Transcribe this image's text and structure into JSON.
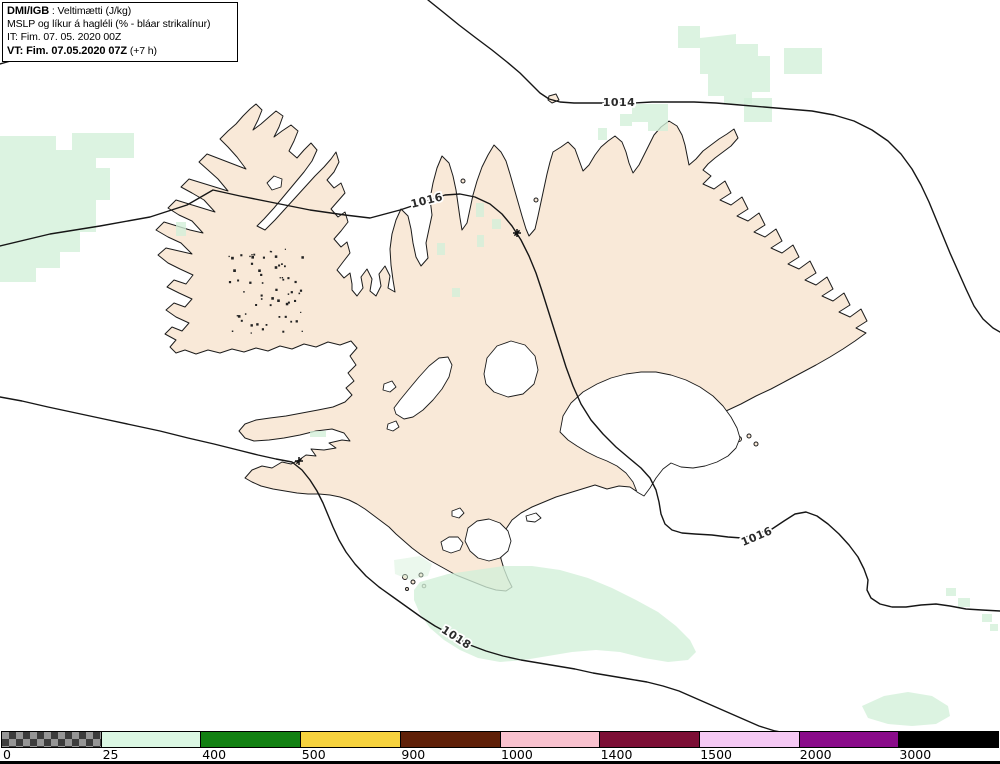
{
  "header": {
    "model": "DMI/IGB",
    "sep": " : ",
    "field": "Veltimætti (J/kg)",
    "line2": "MSLP og líkur á hagléli (% - bláar strikalínur)",
    "init_time": "IT: Fim. 07. 05. 2020 00Z",
    "valid_time_bold": "VT: Fim. 07.05.2020 07Z",
    "valid_time_rest": " (+7 h)"
  },
  "map": {
    "contour_labels": [
      {
        "text": "1014",
        "x": 619,
        "y": 103,
        "rot": 0
      },
      {
        "text": "1016",
        "x": 427,
        "y": 201,
        "rot": -14
      },
      {
        "text": "1016",
        "x": 757,
        "y": 537,
        "rot": -23
      },
      {
        "text": "1018",
        "x": 456,
        "y": 638,
        "rot": 33
      }
    ],
    "isobar_values": [
      "1014",
      "1016",
      "1016",
      "1018"
    ],
    "markers": [
      {
        "x": 299,
        "y": 461
      },
      {
        "x": 517,
        "y": 233
      }
    ]
  },
  "colorbar": {
    "segments": [
      {
        "value": "0",
        "pattern": "checker",
        "color": "#969696"
      },
      {
        "value": "25",
        "color": "#dbf7e3"
      },
      {
        "value": "400",
        "color": "#128012"
      },
      {
        "value": "500",
        "color": "#f6d23e"
      },
      {
        "value": "900",
        "color": "#5f2008"
      },
      {
        "value": "1000",
        "color": "#f9c2cf"
      },
      {
        "value": "1400",
        "color": "#7c0e35"
      },
      {
        "value": "1500",
        "color": "#f5c9f4"
      },
      {
        "value": "2000",
        "color": "#8a0b8a"
      },
      {
        "value": "3000",
        "color": "#000000"
      }
    ]
  },
  "colors": {
    "sea": "#ffffff",
    "land": "#f9e9d8",
    "glacier": "#ffffff",
    "coast": "#1c1c1c",
    "contour": "#161616",
    "shaded_field": "#d2f0d8"
  }
}
